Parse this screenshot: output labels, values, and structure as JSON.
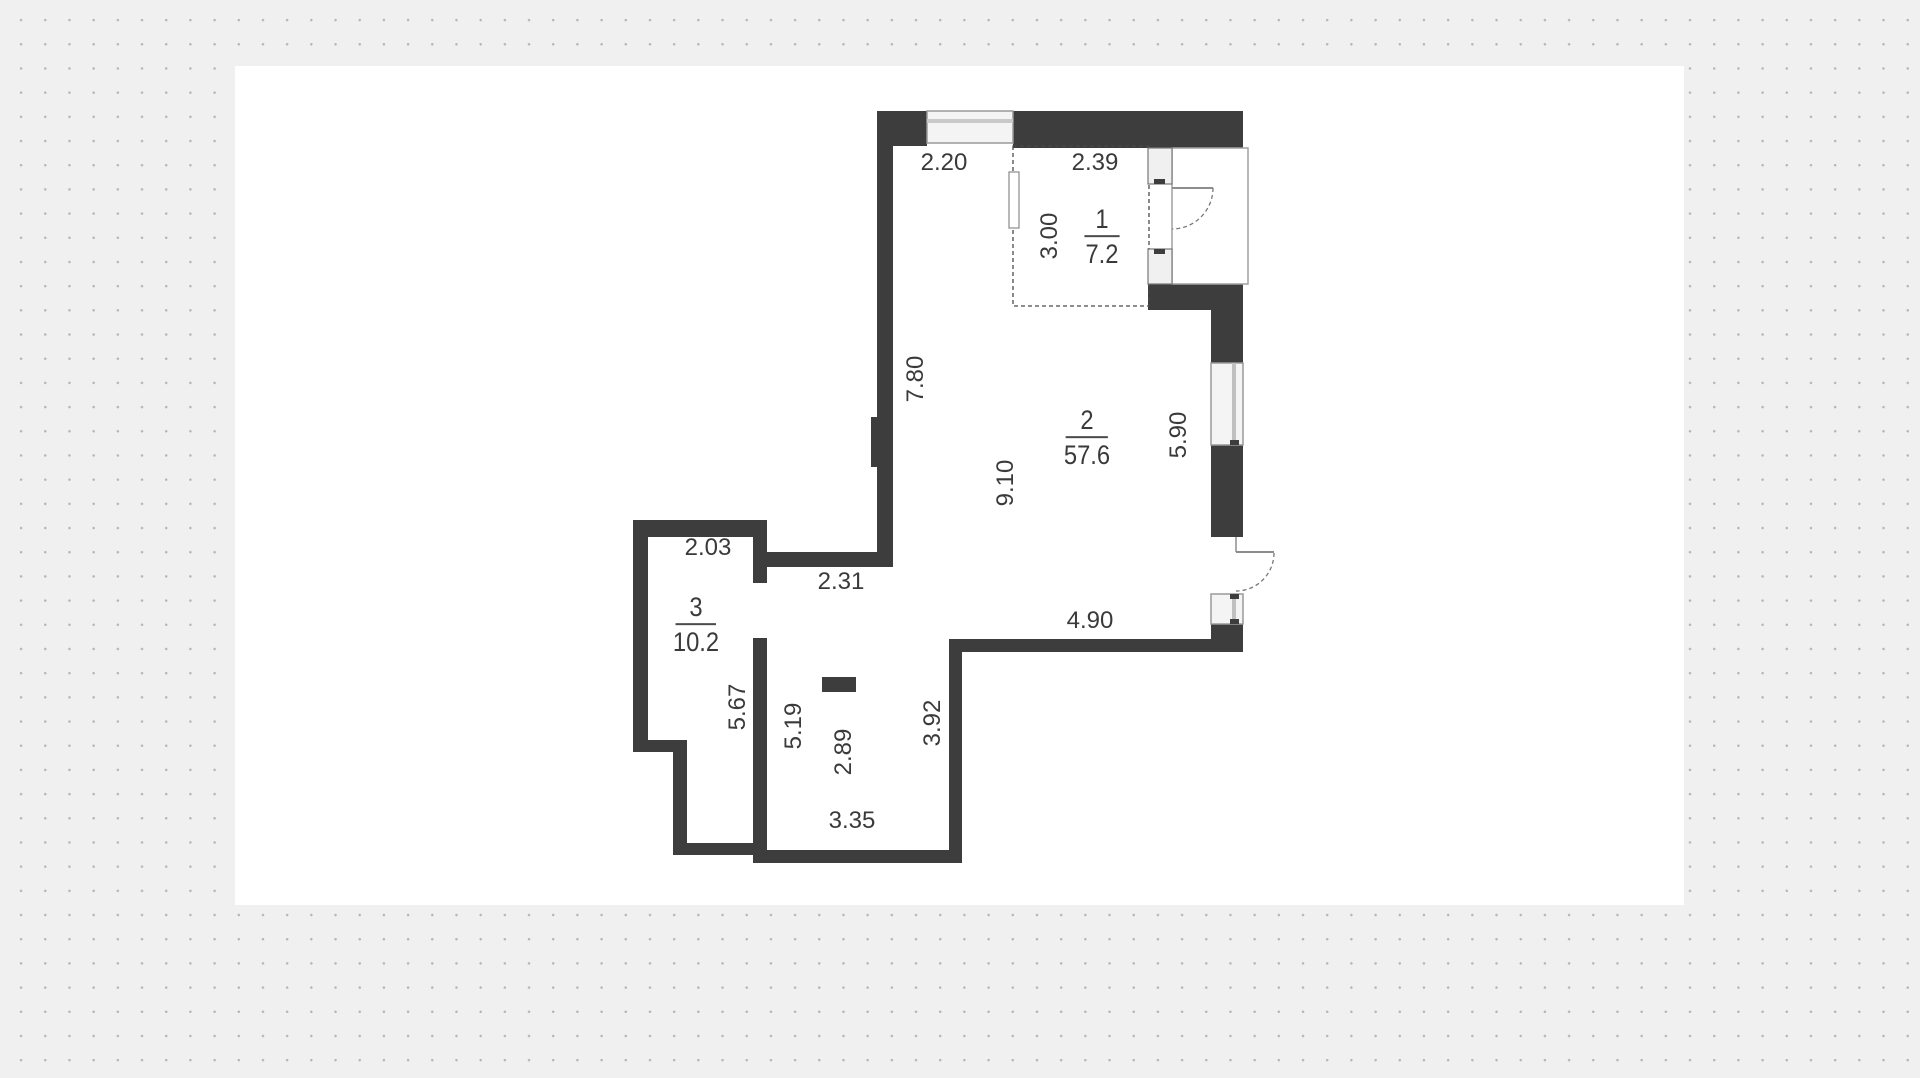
{
  "scene": {
    "background_color": "#f0f0f0",
    "dot_color": "#b6b6b6",
    "canvas_color": "#ffffff"
  },
  "floor_plan": {
    "colors": {
      "wall": "#3d3d3d",
      "text": "#3a3a3a",
      "window_fill": "#f4f4f4",
      "window_stroke": "#9a9a9a",
      "dashed_outline": "#4a4a4a"
    },
    "rooms": [
      {
        "number": "1",
        "area": "7.2",
        "cx": 1102,
        "cy": 237,
        "divider_w": 40
      },
      {
        "number": "2",
        "area": "57.6",
        "cx": 1087,
        "cy": 438,
        "divider_w": 48
      },
      {
        "number": "3",
        "area": "10.2",
        "cx": 696,
        "cy": 625,
        "divider_w": 46
      }
    ],
    "dimensions": [
      {
        "value": "2.20",
        "cx": 944,
        "cy": 163,
        "rotated": false
      },
      {
        "value": "2.39",
        "cx": 1095,
        "cy": 163,
        "rotated": false
      },
      {
        "value": "3.00",
        "cx": 1050,
        "cy": 236,
        "rotated": true
      },
      {
        "value": "7.80",
        "cx": 916,
        "cy": 379,
        "rotated": true
      },
      {
        "value": "9.10",
        "cx": 1006,
        "cy": 483,
        "rotated": true
      },
      {
        "value": "5.90",
        "cx": 1179,
        "cy": 435,
        "rotated": true
      },
      {
        "value": "2.03",
        "cx": 708,
        "cy": 548,
        "rotated": false
      },
      {
        "value": "2.31",
        "cx": 841,
        "cy": 582,
        "rotated": false
      },
      {
        "value": "4.90",
        "cx": 1090,
        "cy": 621,
        "rotated": false
      },
      {
        "value": "5.67",
        "cx": 738,
        "cy": 707,
        "rotated": true
      },
      {
        "value": "5.19",
        "cx": 794,
        "cy": 726,
        "rotated": true
      },
      {
        "value": "2.89",
        "cx": 844,
        "cy": 752,
        "rotated": true
      },
      {
        "value": "3.92",
        "cx": 933,
        "cy": 723,
        "rotated": true
      },
      {
        "value": "3.35",
        "cx": 852,
        "cy": 821,
        "rotated": false
      }
    ]
  }
}
